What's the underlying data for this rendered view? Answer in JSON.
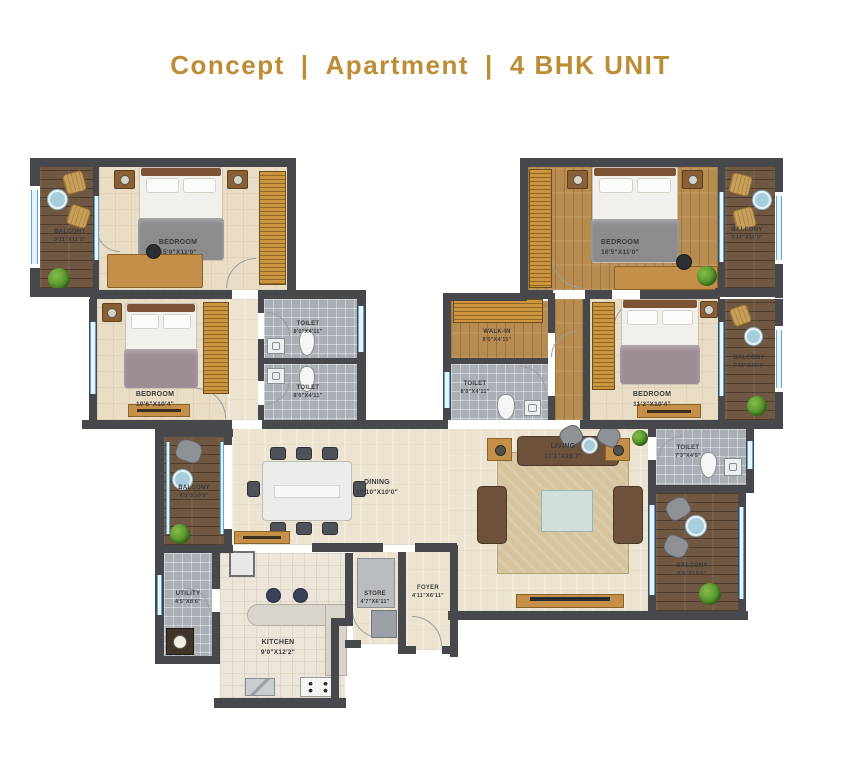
{
  "title": {
    "brand": "Concept",
    "separator": "|",
    "category": "Apartment",
    "unit": "4 BHK UNIT"
  },
  "colors": {
    "accent": "#BD8C34",
    "wall": "#47484B",
    "floor_cream": "#ECE3D0",
    "floor_wood": "#B78C50",
    "deck_wood": "#6F5741",
    "tile_gray": "#A9AFB4",
    "window_blue": "#58A8DC"
  },
  "rooms": {
    "bedroom1": {
      "name": "BEDROOM",
      "dims": "15'9\"X11'0\""
    },
    "balcony_tl": {
      "name": "BALCONY",
      "dims": "3'11\"X11'0\""
    },
    "bedroom2": {
      "name": "BEDROOM",
      "dims": "10'6\"X10'4\""
    },
    "toilet1": {
      "name": "TOILET",
      "dims": "8'0\"X4'11\""
    },
    "toilet2": {
      "name": "TOILET",
      "dims": "8'0\"X4'11\""
    },
    "master_bedroom": {
      "name": "BEDROOM",
      "dims": "16'5\"X11'0\""
    },
    "balcony_tr": {
      "name": "BALCONY",
      "dims": "3'11\"X11'0\""
    },
    "walk_in": {
      "name": "WALK-IN",
      "dims": "8'0\"X4'11\""
    },
    "toilet3": {
      "name": "TOILET",
      "dims": "8'0\"X4'11\""
    },
    "bedroom3": {
      "name": "BEDROOM",
      "dims": "11'2\"X10'4\""
    },
    "balcony_r": {
      "name": "BALCONY",
      "dims": "3'11\"X10'4\""
    },
    "toilet4": {
      "name": "TOILET",
      "dims": "7'3\"X4'5\""
    },
    "balcony_br": {
      "name": "BALCONY",
      "dims": "5'5\"X10'6\""
    },
    "living": {
      "name": "LIVING",
      "dims": "17'1\"X15'7\""
    },
    "dining": {
      "name": "DINING",
      "dims": "19'10\"X10'0\""
    },
    "balcony_l": {
      "name": "BALCONY",
      "dims": "4'5\"X10'0\""
    },
    "utility": {
      "name": "UTILITY",
      "dims": "4'5\"X8'6\""
    },
    "kitchen": {
      "name": "KITCHEN",
      "dims": "9'0\"X12'2\""
    },
    "store": {
      "name": "STORE",
      "dims": "4'7\"X6'11\""
    },
    "foyer": {
      "name": "FOYER",
      "dims": "4'11\"X6'11\""
    }
  }
}
